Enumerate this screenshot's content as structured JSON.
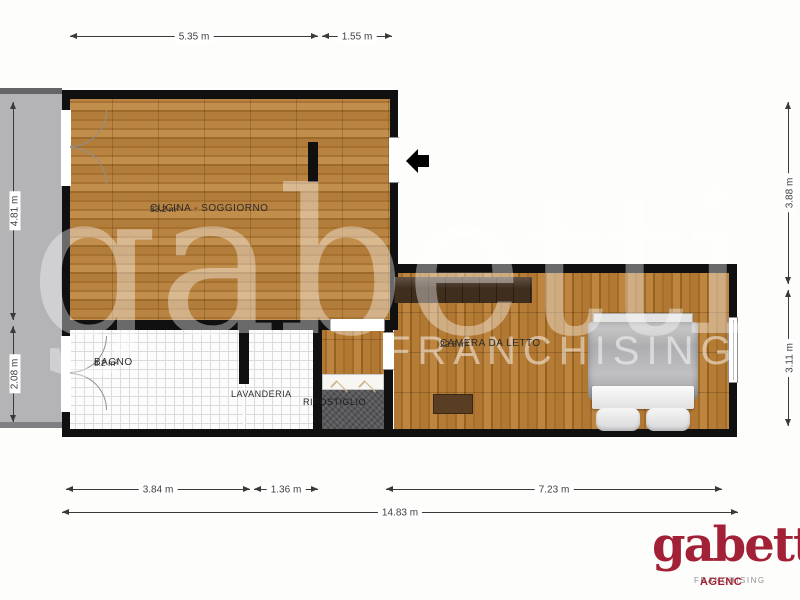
{
  "plan": {
    "type": "apartment-floor-plan",
    "rooms": {
      "cucina": {
        "name": "CUCINA - SOGGIORNO",
        "area": "33.2 m²"
      },
      "bagno": {
        "name": "BAGNO",
        "area": "8.2 m²"
      },
      "lavanderia": {
        "name": "LAVANDERIA"
      },
      "ripostiglio": {
        "name": "RIPOSTIGLIO"
      },
      "camera": {
        "name": "CAMERA DA LETTO",
        "area": "22.8 m²"
      }
    },
    "dims": {
      "top_kitchen": "5.35 m",
      "top_entry": "1.55 m",
      "bottom_bagno": "3.84 m",
      "bottom_lavanderia": "1.36 m",
      "bottom_camera": "7.23 m",
      "bottom_total": "14.83 m",
      "left_kitchen": "4.81 m",
      "left_bagno": "2.08 m",
      "right_upper": "3.88 m",
      "right_lower": "3.11 m"
    },
    "icons": {
      "entrance": "arrow-left-entry"
    }
  },
  "watermark": {
    "brand": "gabetti",
    "subtitle": "FRANCHISING"
  },
  "logo": {
    "brand": "gabetti",
    "franchising": "FRANCHISING",
    "agency": "AGENC"
  },
  "colors": {
    "brand_red": "#a22136",
    "wall": "#101010",
    "wood": "#b5803e",
    "tile_grid": "#dcdcdc",
    "balcony_gray": "#b4b4b6",
    "carpet_gray": "#57575a"
  }
}
